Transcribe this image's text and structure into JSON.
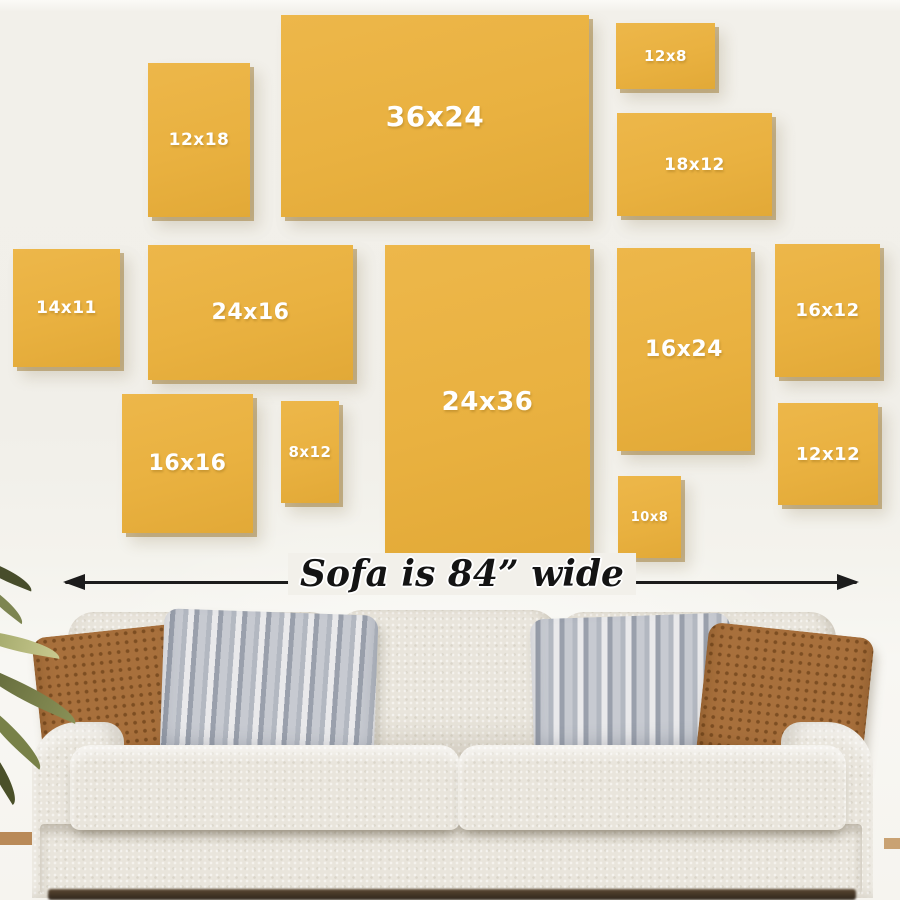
{
  "scene": {
    "description": "Canvas print size guide displayed on a wall above a sofa",
    "colors": {
      "wall": "#f2f0ea",
      "frame": "#e9b140",
      "frame-label": "#ffffff",
      "arrow": "#1c1c1c",
      "sofa-fabric": "#e9e5dc",
      "pillow-rust": "#a8703c",
      "pillow-rust-dark": "#7d4e22",
      "pillow-gray": "#c7cad1",
      "pillow-stripe": "#9aa0ac",
      "floor": "#b98a58"
    }
  },
  "frames": [
    {
      "label": "12x18",
      "x": 148,
      "y": 63,
      "w": 102,
      "h": 154,
      "fs": 17
    },
    {
      "label": "36x24",
      "x": 281,
      "y": 15,
      "w": 308,
      "h": 202,
      "fs": 28
    },
    {
      "label": "12x8",
      "x": 616,
      "y": 23,
      "w": 99,
      "h": 66,
      "fs": 15
    },
    {
      "label": "18x12",
      "x": 617,
      "y": 113,
      "w": 155,
      "h": 103,
      "fs": 17
    },
    {
      "label": "14x11",
      "x": 13,
      "y": 249,
      "w": 107,
      "h": 118,
      "fs": 17
    },
    {
      "label": "24x16",
      "x": 148,
      "y": 245,
      "w": 205,
      "h": 135,
      "fs": 22
    },
    {
      "label": "24x36",
      "x": 385,
      "y": 245,
      "w": 205,
      "h": 313,
      "fs": 26
    },
    {
      "label": "16x24",
      "x": 617,
      "y": 248,
      "w": 134,
      "h": 203,
      "fs": 22
    },
    {
      "label": "16x12",
      "x": 775,
      "y": 244,
      "w": 105,
      "h": 133,
      "fs": 18
    },
    {
      "label": "16x16",
      "x": 122,
      "y": 394,
      "w": 131,
      "h": 139,
      "fs": 22
    },
    {
      "label": "8x12",
      "x": 281,
      "y": 401,
      "w": 58,
      "h": 102,
      "fs": 15
    },
    {
      "label": "10x8",
      "x": 618,
      "y": 476,
      "w": 63,
      "h": 82,
      "fs": 13
    },
    {
      "label": "12x12",
      "x": 778,
      "y": 403,
      "w": 100,
      "h": 102,
      "fs": 18
    }
  ],
  "measure": {
    "label": "Sofa is 84” wide"
  }
}
